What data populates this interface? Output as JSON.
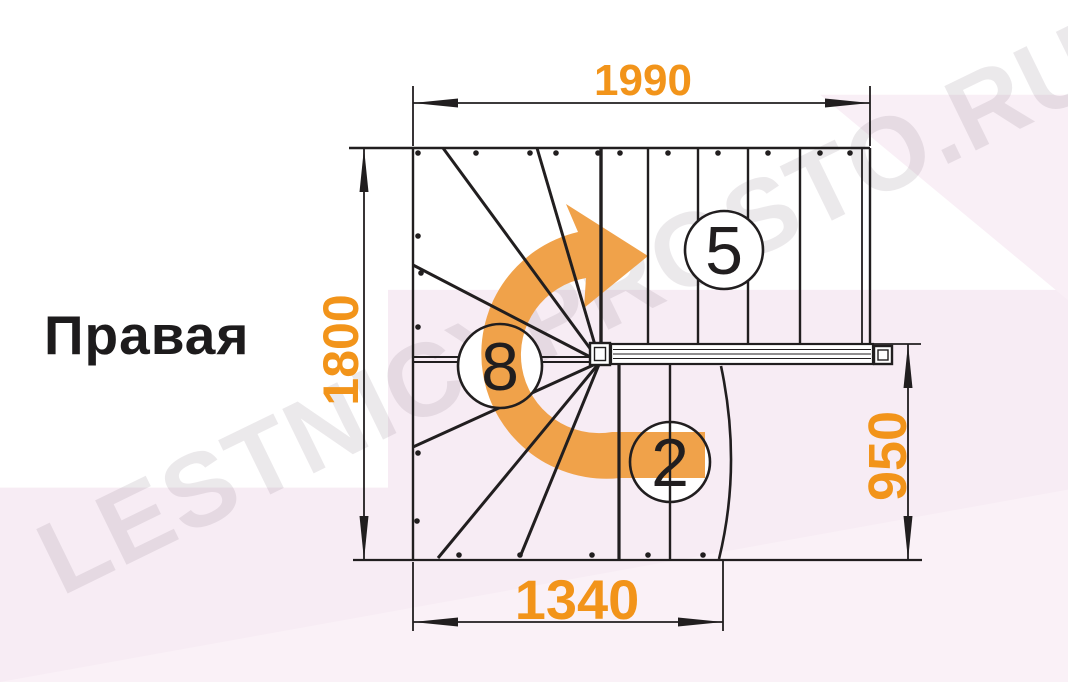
{
  "title": {
    "text": "Правая"
  },
  "watermark": {
    "text": "LESTNICYPROSTO.RU"
  },
  "dimensions": {
    "top_width": "1990",
    "total_depth": "1800",
    "landing_depth": "950",
    "bottom_width": "1340"
  },
  "step_counts": {
    "upper_flight": "5",
    "winders": "8",
    "lower_flight": "2"
  },
  "colors": {
    "dimension_orange": "#F2941A",
    "arrow_orange": "#F0A24A",
    "line_black": "#211E1F",
    "background_pink": "#F7ECF4",
    "background_pink_light": "#FAF1F7",
    "background_pink_corner": "#F9EFF6",
    "circle_fill": "#FFFFFF",
    "watermark_gray": "#8A7A88"
  }
}
